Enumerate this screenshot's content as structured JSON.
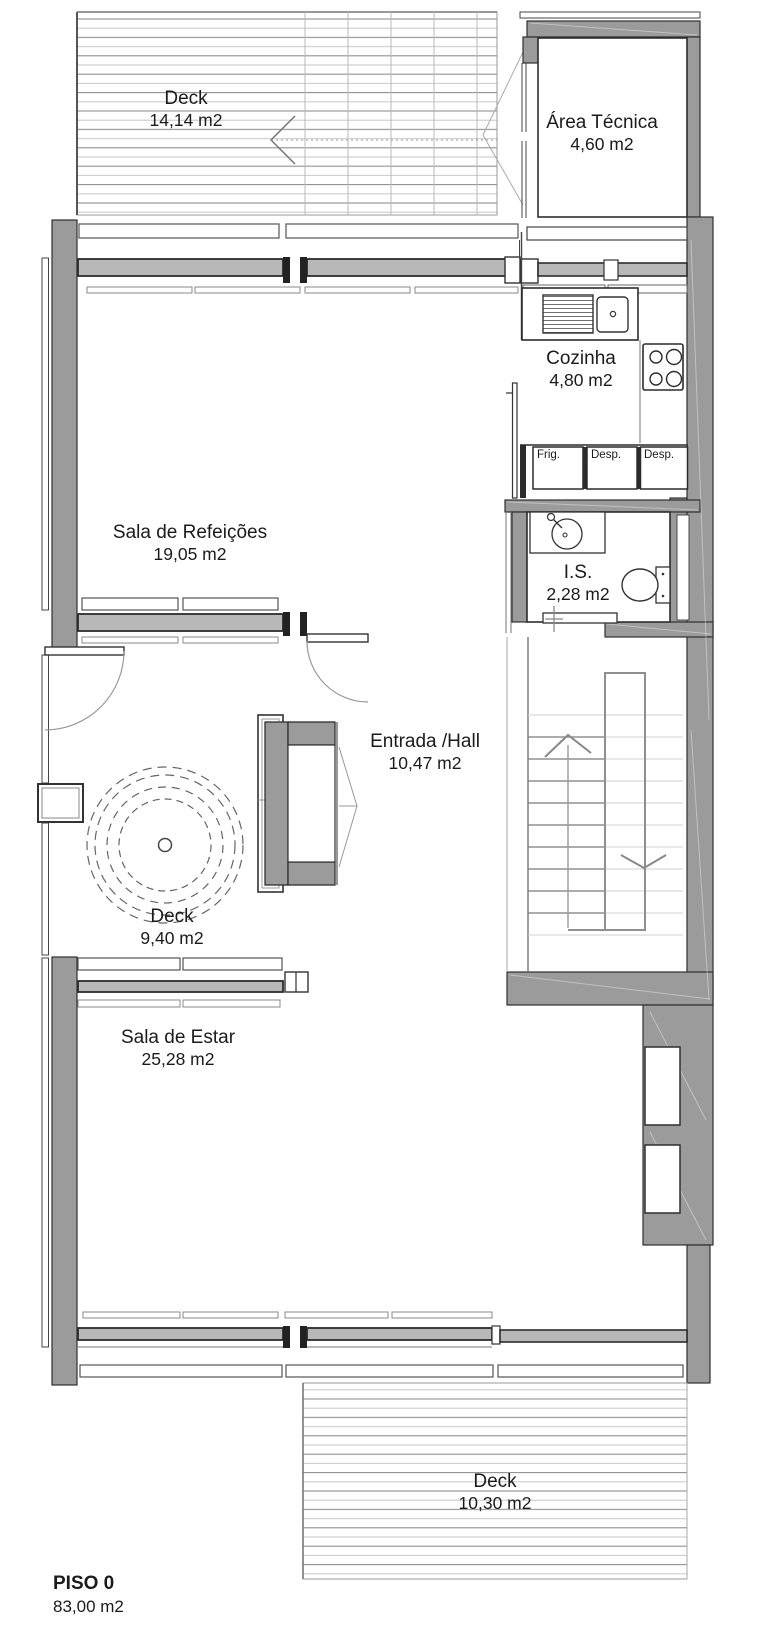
{
  "plan": {
    "floor": {
      "label": "PISO 0",
      "area": "83,00 m2"
    },
    "rooms": [
      {
        "name": "Deck",
        "area": "14,14 m2"
      },
      {
        "name": "Área Técnica",
        "area": "4,60 m2"
      },
      {
        "name": "Cozinha",
        "area": "4,80 m2"
      },
      {
        "name": "Sala de Refeições",
        "area": "19,05 m2"
      },
      {
        "name": "I.S.",
        "area": "2,28 m2"
      },
      {
        "name": "Entrada /Hall",
        "area": "10,47 m2"
      },
      {
        "name": "Deck",
        "area": "9,40 m2"
      },
      {
        "name": "Sala de Estar",
        "area": "25,28 m2"
      },
      {
        "name": "Deck",
        "area": "10,30 m2"
      }
    ],
    "cabinets": [
      {
        "label": "Frig."
      },
      {
        "label": "Desp."
      },
      {
        "label": "Desp."
      }
    ],
    "colors": {
      "wall_fill": "#9b9b9b",
      "wall_outline": "#2f2f2f",
      "glass_fill": "#b8b8b8",
      "deck_line_dark": "#8f8f8f",
      "deck_line_light": "#c6c6c6",
      "text": "#1b1b1b"
    }
  }
}
